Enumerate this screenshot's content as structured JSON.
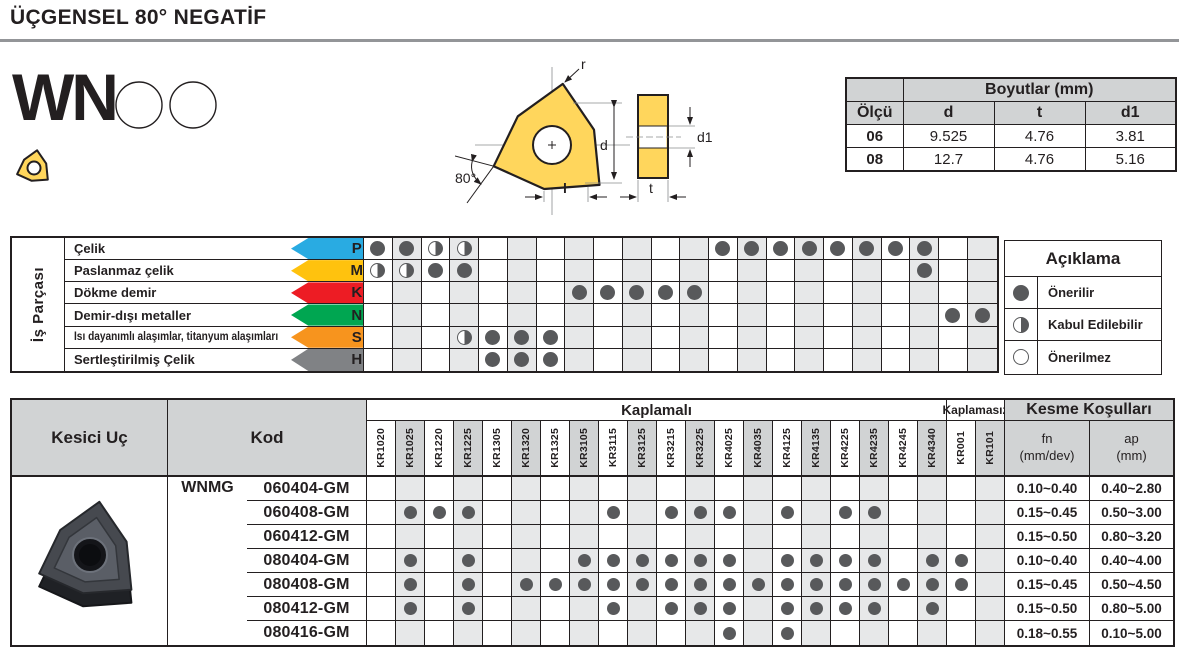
{
  "page": {
    "title": "ÜÇGENSEL 80° NEGATİF",
    "series": "WN"
  },
  "drawing": {
    "labels": {
      "radius": "r",
      "diameter": "d",
      "length": "l",
      "angle": "80°",
      "thickness": "t",
      "hole": "d1"
    }
  },
  "dimensions_table": {
    "title": "Boyutlar (mm)",
    "size_header": "Ölçü",
    "col_headers": [
      "d",
      "t",
      "d1"
    ],
    "rows": [
      {
        "size": "06",
        "d": "9.525",
        "t": "4.76",
        "d1": "3.81"
      },
      {
        "size": "08",
        "d": "12.7",
        "t": "4.76",
        "d1": "5.16"
      }
    ]
  },
  "grades": {
    "coated_label": "Kaplamalı",
    "uncoated_label": "Kaplamasız",
    "coated": [
      "KR1020",
      "KR1025",
      "KR1220",
      "KR1225",
      "KR1305",
      "KR1320",
      "KR1325",
      "KR3105",
      "KR3115",
      "KR3125",
      "KR3215",
      "KR3225",
      "KR4025",
      "KR4035",
      "KR4125",
      "KR4135",
      "KR4225",
      "KR4235",
      "KR4245",
      "KR4340"
    ],
    "uncoated": [
      "KR001",
      "KR101"
    ]
  },
  "material_table": {
    "row_header": "İş Parçası",
    "materials": [
      {
        "name": "Çelik",
        "letter": "P",
        "color": "#29ABE2",
        "ratings": {
          "KR1020": "full",
          "KR1025": "full",
          "KR1220": "half",
          "KR1225": "half",
          "KR4025": "full",
          "KR4035": "full",
          "KR4125": "full",
          "KR4135": "full",
          "KR4225": "full",
          "KR4235": "full",
          "KR4245": "full",
          "KR4340": "full"
        }
      },
      {
        "name": "Paslanmaz çelik",
        "letter": "M",
        "color": "#FFC20E",
        "ratings": {
          "KR1020": "half",
          "KR1025": "half",
          "KR1220": "full",
          "KR1225": "full",
          "KR4340": "full"
        }
      },
      {
        "name": "Dökme demir",
        "letter": "K",
        "color": "#ED1C24",
        "ratings": {
          "KR3105": "full",
          "KR3115": "full",
          "KR3125": "full",
          "KR3215": "full",
          "KR3225": "full"
        }
      },
      {
        "name": "Demir-dışı metaller",
        "letter": "N",
        "color": "#00A651",
        "ratings": {
          "KR001": "full",
          "KR101": "full"
        }
      },
      {
        "name": "Isı dayanımlı alaşımlar, titanyum alaşımları",
        "letter": "S",
        "color": "#F7941E",
        "ratings": {
          "KR1225": "half",
          "KR1305": "full",
          "KR1320": "full",
          "KR1325": "full"
        }
      },
      {
        "name": "Sertleştirilmiş Çelik",
        "letter": "H",
        "color": "#808285",
        "ratings": {
          "KR1305": "full",
          "KR1320": "full",
          "KR1325": "full"
        }
      }
    ]
  },
  "legend": {
    "title": "Açıklama",
    "items": [
      {
        "symbol": "full",
        "label": "Önerilir"
      },
      {
        "symbol": "half",
        "label": "Kabul Edilebilir"
      },
      {
        "symbol": "empty",
        "label": "Önerilmez"
      }
    ]
  },
  "products_table": {
    "insert_header": "Kesici Uç",
    "code_header": "Kod",
    "cutting_header": "Kesme Koşulları",
    "fn_header": "fn",
    "fn_unit": "(mm/dev)",
    "ap_header": "ap",
    "ap_unit": "(mm)",
    "series": "WNMG",
    "rows": [
      {
        "code": "060404-GM",
        "grades": [],
        "fn": "0.10~0.40",
        "ap": "0.40~2.80"
      },
      {
        "code": "060408-GM",
        "grades": [
          "KR1025",
          "KR1220",
          "KR1225",
          "KR3115",
          "KR3215",
          "KR3225",
          "KR4025",
          "KR4125",
          "KR4225",
          "KR4235"
        ],
        "fn": "0.15~0.45",
        "ap": "0.50~3.00"
      },
      {
        "code": "060412-GM",
        "grades": [],
        "fn": "0.15~0.50",
        "ap": "0.80~3.20"
      },
      {
        "code": "080404-GM",
        "grades": [
          "KR1025",
          "KR1225",
          "KR3105",
          "KR3115",
          "KR3125",
          "KR3215",
          "KR3225",
          "KR4025",
          "KR4125",
          "KR4135",
          "KR4225",
          "KR4235",
          "KR4340",
          "KR001"
        ],
        "fn": "0.10~0.40",
        "ap": "0.40~4.00"
      },
      {
        "code": "080408-GM",
        "grades": [
          "KR1025",
          "KR1225",
          "KR1320",
          "KR1325",
          "KR3105",
          "KR3115",
          "KR3125",
          "KR3215",
          "KR3225",
          "KR4025",
          "KR4035",
          "KR4125",
          "KR4135",
          "KR4225",
          "KR4235",
          "KR4245",
          "KR4340",
          "KR001"
        ],
        "fn": "0.15~0.45",
        "ap": "0.50~4.50"
      },
      {
        "code": "080412-GM",
        "grades": [
          "KR1025",
          "KR1225",
          "KR3115",
          "KR3215",
          "KR3225",
          "KR4025",
          "KR4125",
          "KR4135",
          "KR4225",
          "KR4235",
          "KR4340"
        ],
        "fn": "0.15~0.50",
        "ap": "0.80~5.00"
      },
      {
        "code": "080416-GM",
        "grades": [
          "KR4025",
          "KR4125"
        ],
        "fn": "0.18~0.55",
        "ap": "0.10~5.00"
      }
    ]
  },
  "colors": {
    "ink": "#231f20",
    "header_gray": "#d1d3d4",
    "column_shade": "#e7e8e9",
    "dot": "#58595b",
    "insert_yellow": "#FFD65C",
    "p_blue": "#29ABE2",
    "m_yellow": "#FFC20E",
    "k_red": "#ED1C24",
    "n_green": "#00A651",
    "s_orange": "#F7941E",
    "h_gray": "#808285"
  }
}
